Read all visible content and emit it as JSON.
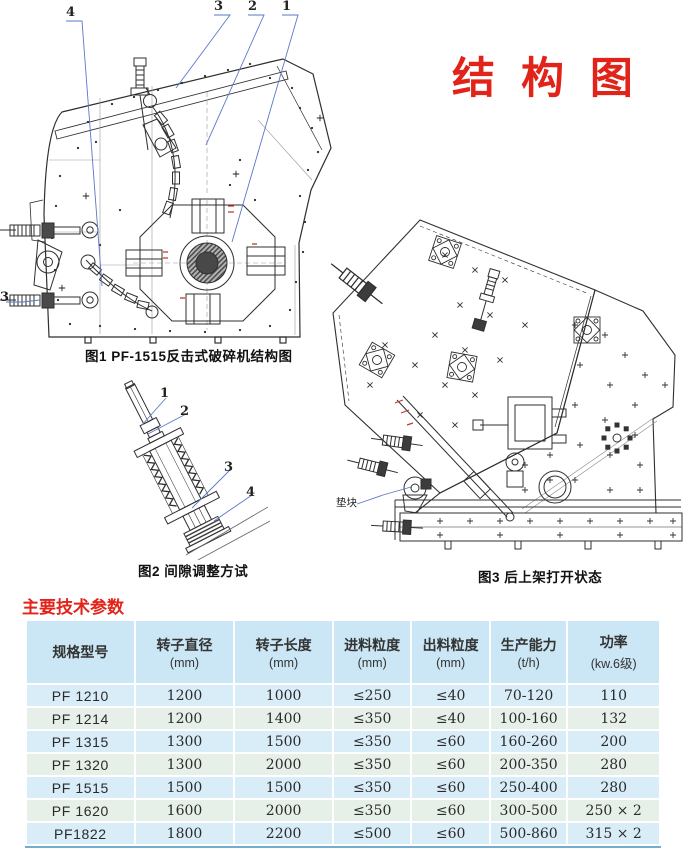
{
  "page": {
    "title": "结 构 图"
  },
  "figure1": {
    "caption": "图1 PF-1515反击式破碎机结构图",
    "callout_4": "4",
    "callout_3": "3",
    "callout_2": "2",
    "callout_1": "1",
    "callout_left_3": "3"
  },
  "figure2": {
    "caption": "图2 间隙调整方试",
    "callout_1": "1",
    "callout_2": "2",
    "callout_3": "3",
    "callout_4": "4"
  },
  "figure3": {
    "caption": "图3 后上架打开状态",
    "pad_label": "垫块"
  },
  "section": {
    "heading": "主要技术参数"
  },
  "table": {
    "headers": [
      {
        "name": "规格型号",
        "unit": ""
      },
      {
        "name": "转子直径",
        "unit": "(mm)"
      },
      {
        "name": "转子长度",
        "unit": "(mm)"
      },
      {
        "name": "进料粒度",
        "unit": "(mm)"
      },
      {
        "name": "出料粒度",
        "unit": "(mm)"
      },
      {
        "name": "生产能力",
        "unit": "(t/h)"
      },
      {
        "name": "功率",
        "unit": "(kw.6级)"
      }
    ],
    "rows": [
      {
        "model": "PF 1210",
        "rotor_diameter": "1200",
        "rotor_length": "1000",
        "feed_size": "≤250",
        "output_size": "≤40",
        "capacity": "70-120",
        "power": "110"
      },
      {
        "model": "PF 1214",
        "rotor_diameter": "1200",
        "rotor_length": "1400",
        "feed_size": "≤350",
        "output_size": "≤40",
        "capacity": "100-160",
        "power": "132"
      },
      {
        "model": "PF 1315",
        "rotor_diameter": "1300",
        "rotor_length": "1500",
        "feed_size": "≤350",
        "output_size": "≤60",
        "capacity": "160-260",
        "power": "200"
      },
      {
        "model": "PF 1320",
        "rotor_diameter": "1300",
        "rotor_length": "2000",
        "feed_size": "≤350",
        "output_size": "≤60",
        "capacity": "200-350",
        "power": "280"
      },
      {
        "model": "PF 1515",
        "rotor_diameter": "1500",
        "rotor_length": "1500",
        "feed_size": "≤350",
        "output_size": "≤60",
        "capacity": "250-400",
        "power": "280"
      },
      {
        "model": "PF 1620",
        "rotor_diameter": "1600",
        "rotor_length": "2000",
        "feed_size": "≤350",
        "output_size": "≤60",
        "capacity": "300-500",
        "power": "250 × 2"
      },
      {
        "model": "PF1822",
        "rotor_diameter": "1800",
        "rotor_length": "2200",
        "feed_size": "≤500",
        "output_size": "≤60",
        "capacity": "500-860",
        "power": "315 × 2"
      }
    ]
  },
  "colors": {
    "accent_red": "#e2231a",
    "leader_blue": "#5b77c9",
    "header_blue": "#cbe6f4",
    "row_blue": "#d9edf8",
    "row_green": "#e6f0e8"
  }
}
